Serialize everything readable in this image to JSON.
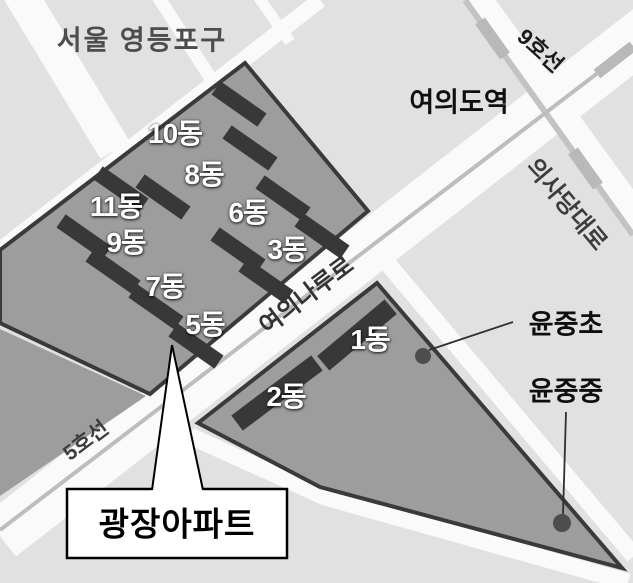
{
  "map_title": "서울 영등포구",
  "station": {
    "name": "여의도역"
  },
  "subway_lines": {
    "line9": "9호선",
    "line5": "5호선"
  },
  "roads": {
    "uisadang_daero": "의사당대로",
    "yeouinaru_ro": "여의나루로"
  },
  "apartment": {
    "name": "광장아파트",
    "buildings": [
      {
        "label": "10동"
      },
      {
        "label": "8동"
      },
      {
        "label": "6동"
      },
      {
        "label": "3동"
      },
      {
        "label": "11동"
      },
      {
        "label": "9동"
      },
      {
        "label": "7동"
      },
      {
        "label": "5동"
      },
      {
        "label": "1동"
      },
      {
        "label": "2동"
      }
    ]
  },
  "schools": [
    {
      "name": "윤중초"
    },
    {
      "name": "윤중중"
    }
  ],
  "colors": {
    "block": "#e1e1e1",
    "road": "#fafafa",
    "complex_fill": "#9d9d9d",
    "complex_border": "#3a3a3a",
    "building": "#383838",
    "metro_line": "#bdbdbd",
    "station_segment": "#b9b9b9",
    "building_label": "#ffffff",
    "callout_bg": "#ffffff",
    "callout_border": "#000000",
    "school_dot": "#4d4d4d"
  }
}
